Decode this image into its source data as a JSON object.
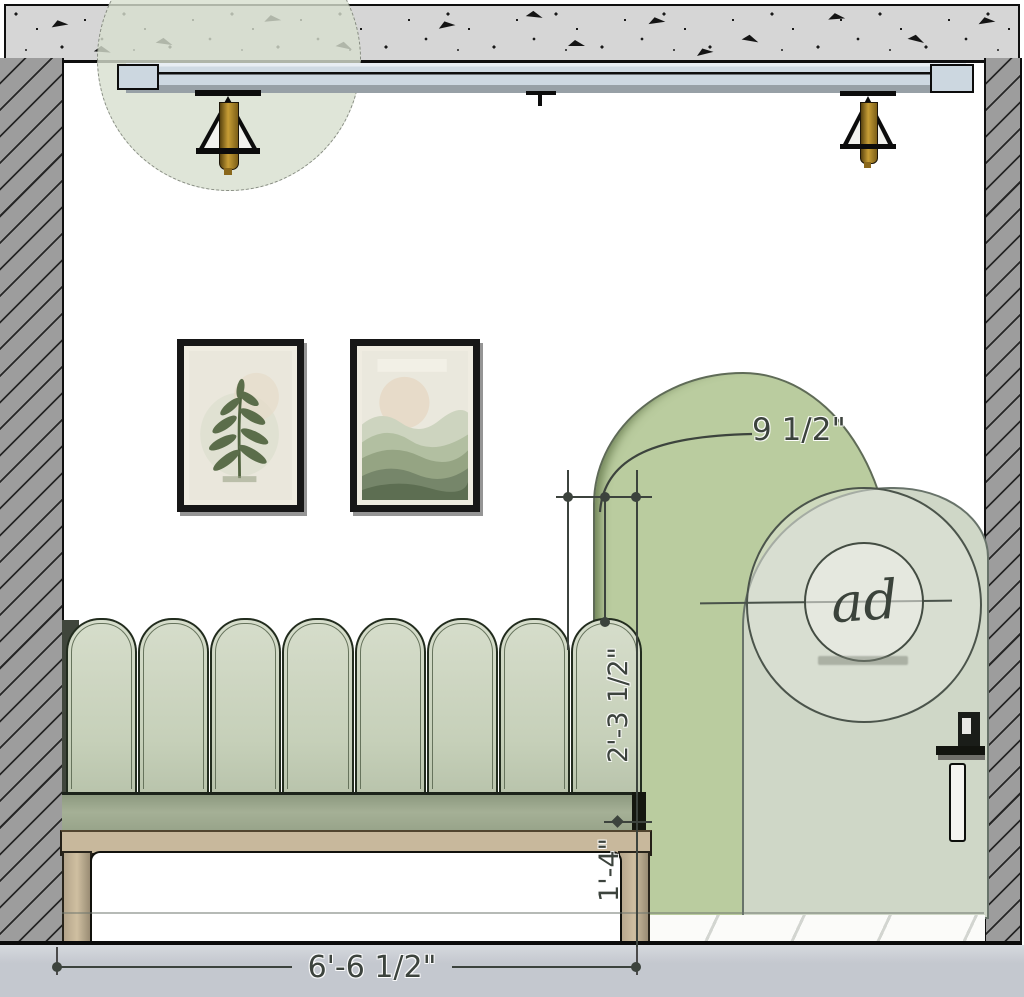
{
  "drawing": {
    "kind": "interior elevation - scalloped banquette with arched partition and door"
  },
  "dimensions": {
    "arch_reveal": "9 1/2\"",
    "backrest_height": "2'-3 1/2\"",
    "seat_height": "1'-4\"",
    "bench_width": "6'-6 1/2\""
  },
  "logo": {
    "monogram": "ad"
  },
  "banquette": {
    "scallop_count": 8
  },
  "colors": {
    "ceiling": "#d6d6d6",
    "wall": "#9d9d9d",
    "arch": "#bacc9f",
    "door": "#cfd7c7",
    "seat": "#a5b096",
    "wood": "#c8b89c",
    "floor": "#c4c8cf",
    "dim": "#3c433d",
    "brass": "#c79d35"
  }
}
